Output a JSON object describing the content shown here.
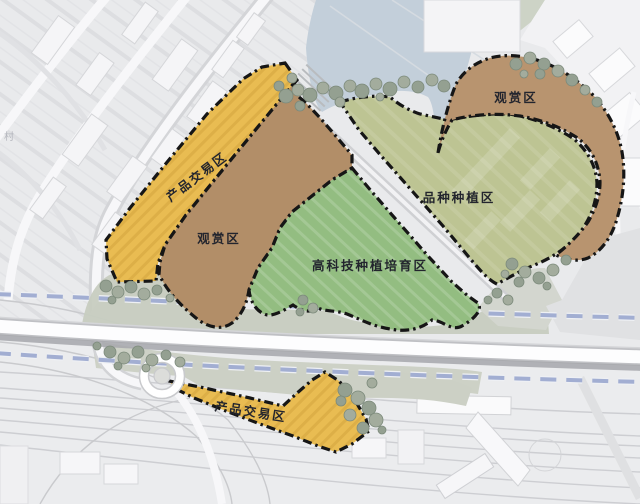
{
  "map": {
    "kind": "landscape-planning-site-plan",
    "background_label": "村",
    "zones": [
      {
        "id": "product-trade-north",
        "label": "产品交易区",
        "color": "#e9bc52"
      },
      {
        "id": "ornamental-west",
        "label": "观赏区",
        "color": "#b28e68"
      },
      {
        "id": "hightech-cultivation",
        "label": "高科技种植培育区",
        "color": "#93bd81"
      },
      {
        "id": "variety-planting",
        "label": "品种种植区",
        "color": "#bdc493"
      },
      {
        "id": "ornamental-northeast",
        "label": "观赏区",
        "color": "#b8946f"
      },
      {
        "id": "product-trade-south",
        "label": "产品交易区",
        "color": "#e9bc52"
      }
    ],
    "colors": {
      "water": "#c3cfda",
      "boundary": "#161616",
      "planning_line": "#a2aed2",
      "highway": "#fdfdfe",
      "trees": "#94a091",
      "label_text": "#23252e"
    }
  }
}
